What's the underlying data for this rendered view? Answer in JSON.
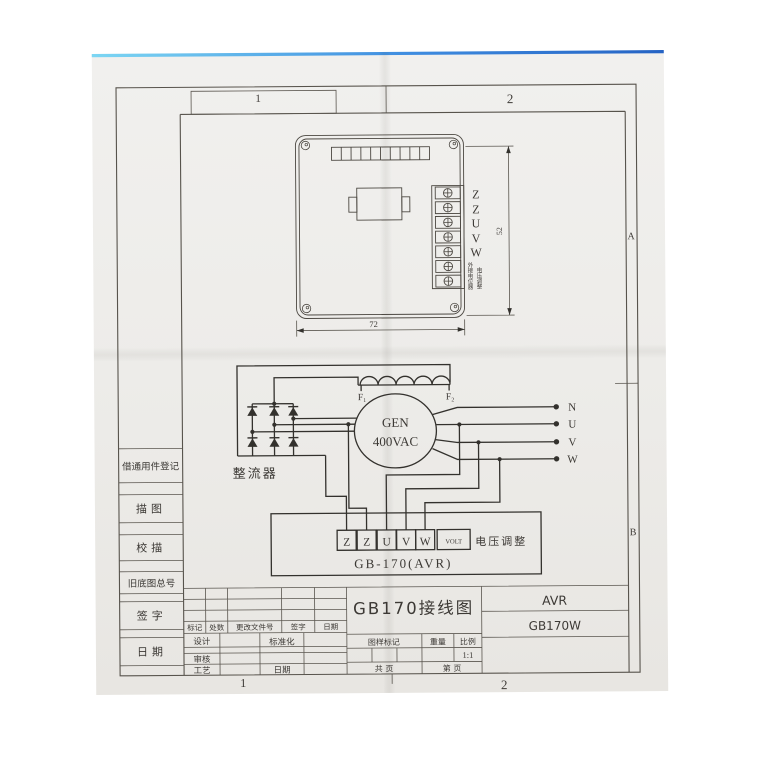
{
  "frame": {
    "zone_top_1": "1",
    "zone_top_2": "2",
    "zone_bottom_1": "1",
    "zone_bottom_2": "2",
    "zone_a": "A",
    "zone_b": "B"
  },
  "device": {
    "terminal_labels": [
      "Z",
      "Z",
      "U",
      "V",
      "W"
    ],
    "pot_label_1": "外接电位器",
    "pot_label_2": "电压调整",
    "dim_width": "72",
    "dim_height": "52"
  },
  "circuit": {
    "f1": "F₁",
    "f2": "F₂",
    "gen_name": "GEN",
    "gen_voltage": "400VAC",
    "rectifier_label": "整流器",
    "output_labels": [
      "N",
      "U",
      "V",
      "W"
    ],
    "avr_terminals": [
      "Z",
      "Z",
      "U",
      "V",
      "W",
      "VOLT"
    ],
    "volt_adjust_label": "电压调整",
    "avr_name": "GB-170(AVR)"
  },
  "title_block": {
    "left_rows": [
      "借通用件登记",
      "描图",
      "校描",
      "旧底图总号",
      "签字",
      "日期"
    ],
    "revision_headers": [
      "标记",
      "处数",
      "更改文件号",
      "签字",
      "日期"
    ],
    "design_label": "设计",
    "standardization_label": "标准化",
    "review_label": "审核",
    "process_label": "工艺",
    "date_label": "日期",
    "drawing_title": "GB170接线图",
    "drawing_mark_label": "图样标记",
    "weight_label": "重量",
    "scale_label": "比例",
    "scale_value": "1:1",
    "sheet_total_label": "共  页",
    "sheet_no_label": "第  页",
    "product_name": "AVR",
    "model": "GB170W"
  }
}
